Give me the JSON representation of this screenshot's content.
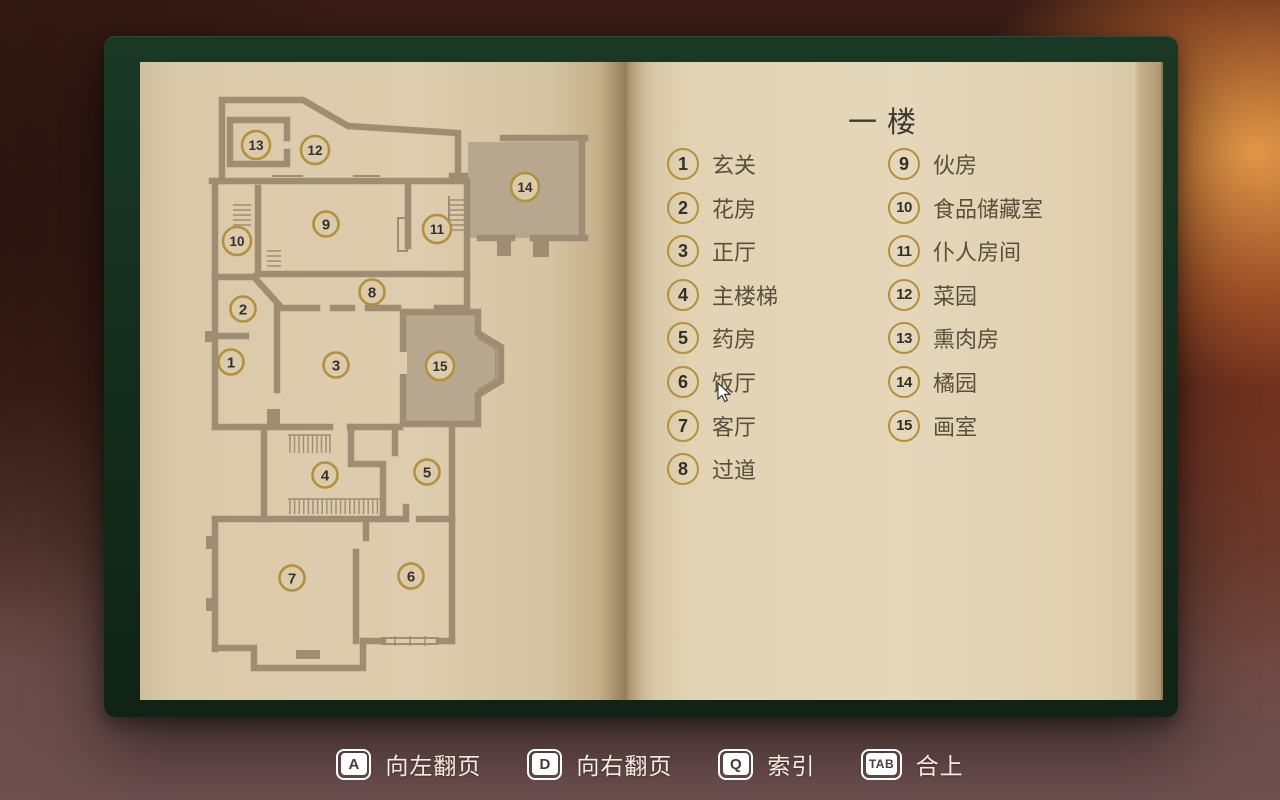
{
  "title": "一楼",
  "legend": {
    "columns": [
      {
        "items": [
          {
            "num": "1",
            "label": "玄关"
          },
          {
            "num": "2",
            "label": "花房"
          },
          {
            "num": "3",
            "label": "正厅"
          },
          {
            "num": "4",
            "label": "主楼梯"
          },
          {
            "num": "5",
            "label": "药房"
          },
          {
            "num": "6",
            "label": "饭厅"
          },
          {
            "num": "7",
            "label": "客厅"
          },
          {
            "num": "8",
            "label": "过道"
          }
        ]
      },
      {
        "items": [
          {
            "num": "9",
            "label": "伙房"
          },
          {
            "num": "10",
            "label": "食品储藏室"
          },
          {
            "num": "11",
            "label": "仆人房间"
          },
          {
            "num": "12",
            "label": "菜园"
          },
          {
            "num": "13",
            "label": "熏肉房"
          },
          {
            "num": "14",
            "label": "橘园"
          },
          {
            "num": "15",
            "label": "画室"
          }
        ]
      }
    ]
  },
  "map": {
    "markers": [
      {
        "num": "1",
        "x": 231,
        "y": 362
      },
      {
        "num": "2",
        "x": 243,
        "y": 309
      },
      {
        "num": "3",
        "x": 336,
        "y": 365
      },
      {
        "num": "4",
        "x": 325,
        "y": 475
      },
      {
        "num": "5",
        "x": 427,
        "y": 472
      },
      {
        "num": "6",
        "x": 411,
        "y": 576
      },
      {
        "num": "7",
        "x": 292,
        "y": 578
      },
      {
        "num": "8",
        "x": 372,
        "y": 292
      },
      {
        "num": "9",
        "x": 326,
        "y": 224
      },
      {
        "num": "10",
        "x": 237,
        "y": 241
      },
      {
        "num": "11",
        "x": 437,
        "y": 229
      },
      {
        "num": "12",
        "x": 315,
        "y": 150
      },
      {
        "num": "13",
        "x": 256,
        "y": 145
      },
      {
        "num": "14",
        "x": 525,
        "y": 187
      },
      {
        "num": "15",
        "x": 440,
        "y": 366
      }
    ]
  },
  "hotkeys": [
    {
      "key": "A",
      "action": "page-left",
      "label": "向左翻页"
    },
    {
      "key": "D",
      "action": "page-right",
      "label": "向右翻页"
    },
    {
      "key": "Q",
      "action": "index",
      "label": "索引"
    },
    {
      "key": "TAB",
      "action": "close",
      "label": "合上"
    }
  ],
  "colors": {
    "accent_gold": "#b2903e",
    "page_cream": "#dcccac",
    "cover_green": "#16301f",
    "wall_taupe": "#9e8c73",
    "room_shade": "#b7a78f",
    "hud_text": "#f2ede2"
  }
}
